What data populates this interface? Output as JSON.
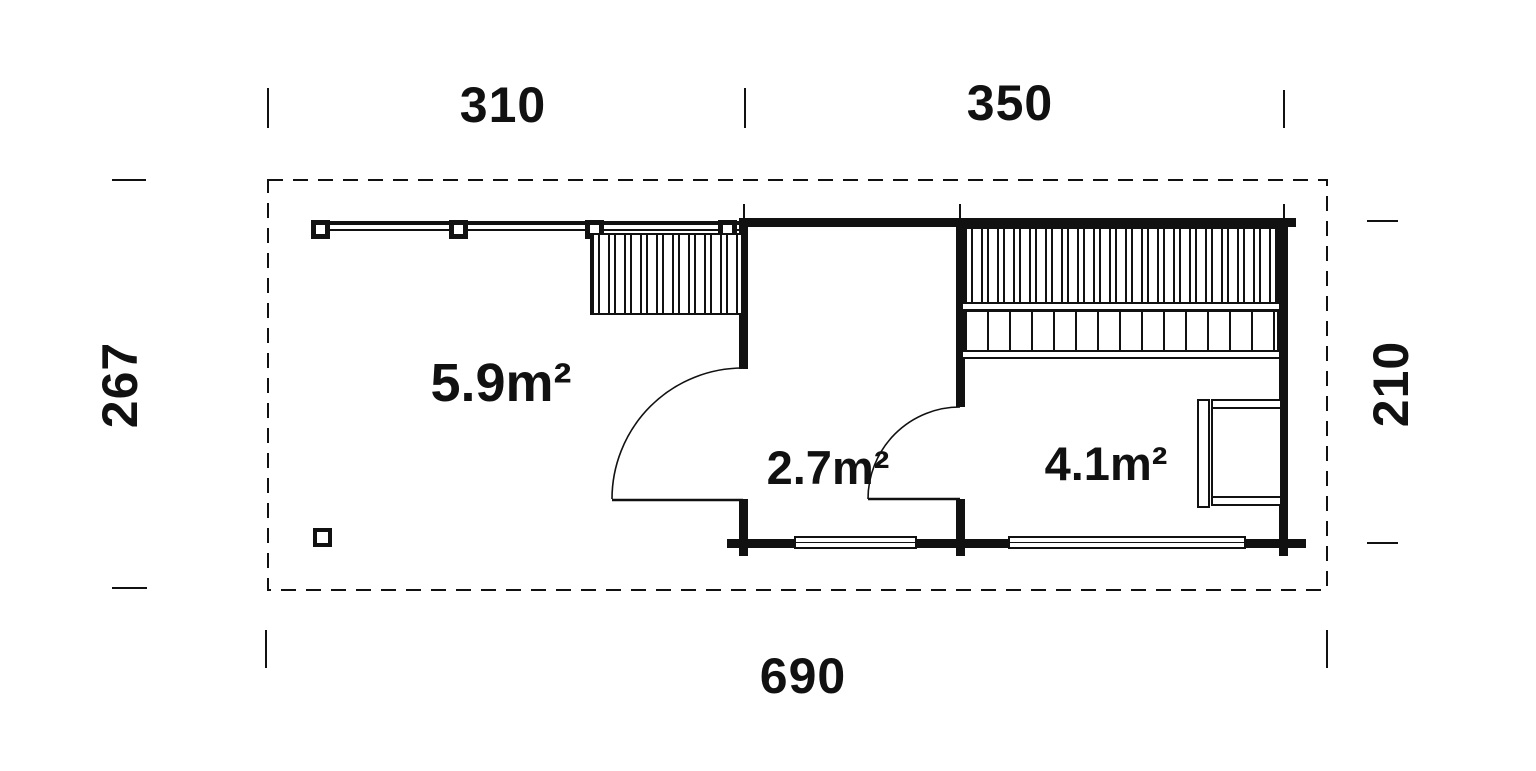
{
  "plan": {
    "title": "sauna-cabin-floor-plan",
    "dimensions": {
      "top_left_width": "310",
      "top_right_width": "350",
      "total_width": "690",
      "left_depth": "267",
      "right_depth": "210"
    },
    "rooms": [
      {
        "id": "terrace",
        "area_label": "5.9m²"
      },
      {
        "id": "front-room",
        "area_label": "2.7m²"
      },
      {
        "id": "sauna-room",
        "area_label": "4.1m²"
      }
    ],
    "colors": {
      "line": "#111111",
      "background": "#ffffff"
    }
  }
}
